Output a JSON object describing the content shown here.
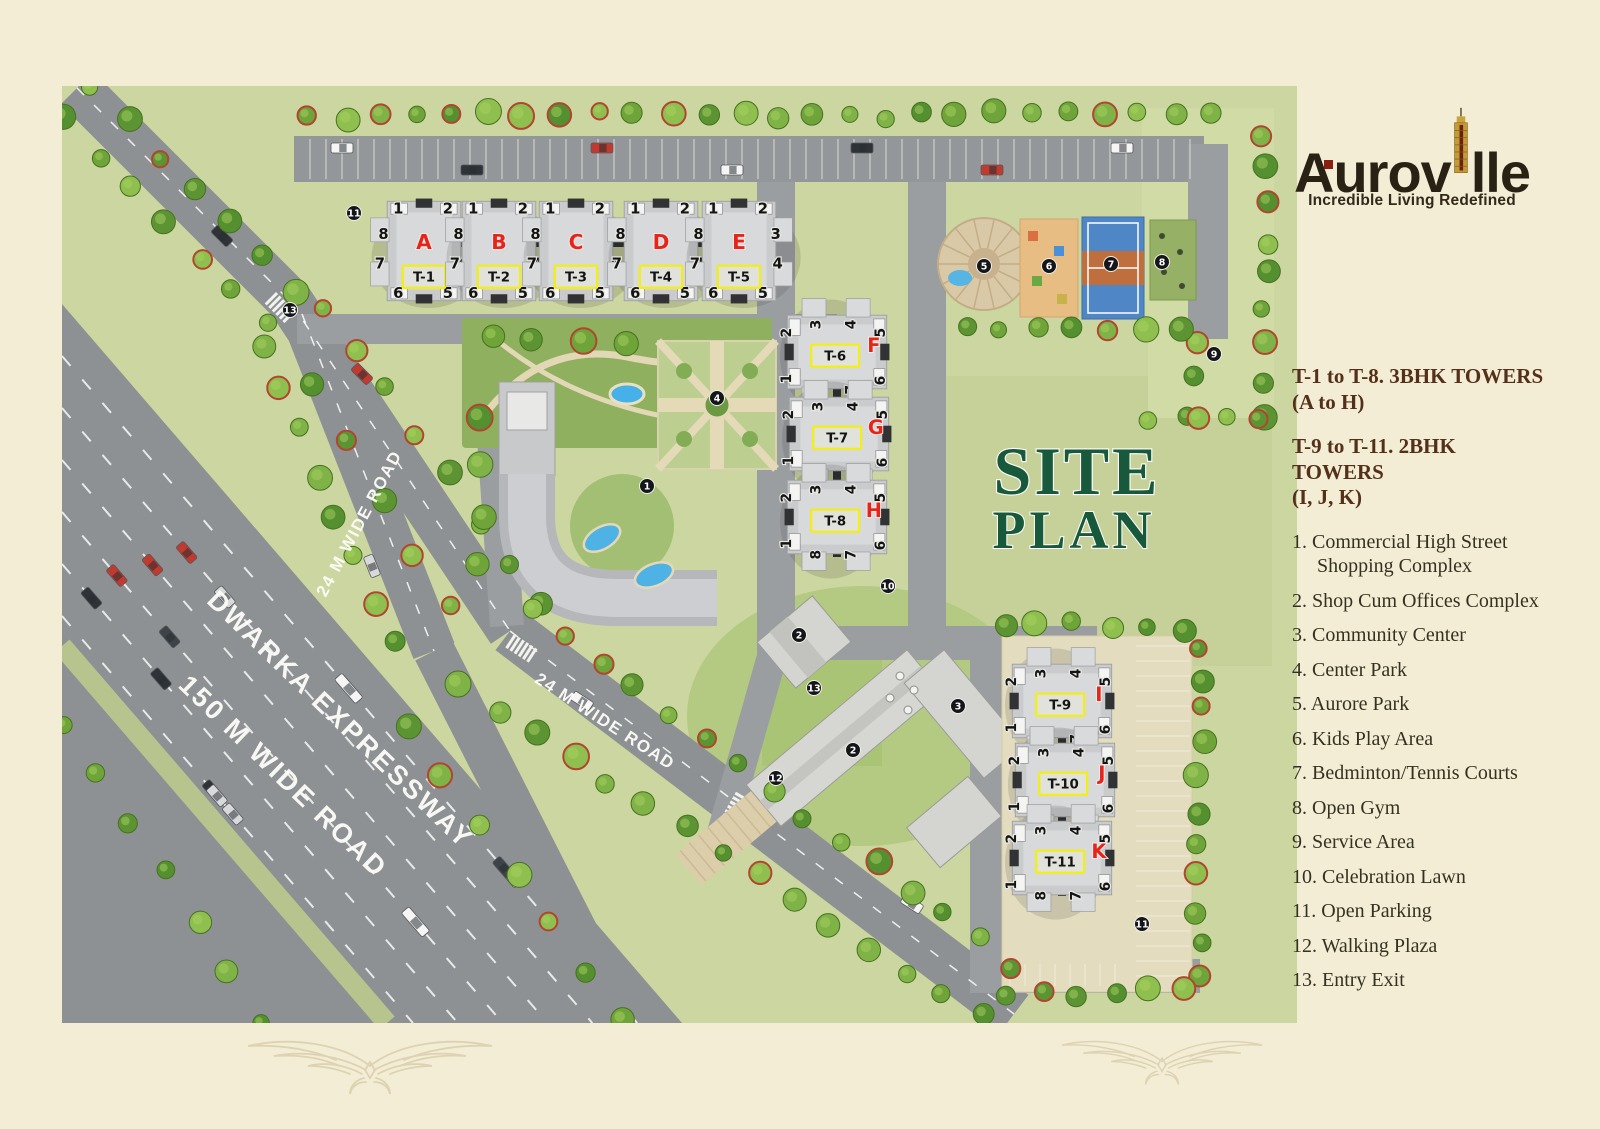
{
  "logo": {
    "name_prefix": "Aurov",
    "name_suffix": "lle",
    "tagline": "Incredible Living Redefined"
  },
  "title": {
    "line1": "SITE",
    "line2": "PLAN"
  },
  "tower_info": [
    {
      "line1": "T-1 to T-8. 3BHK TOWERS",
      "line2": "(A to H)"
    },
    {
      "line1": "T-9 to T-11. 2BHK TOWERS",
      "line2": "(I, J, K)"
    }
  ],
  "legend": {
    "items": [
      {
        "num": "1.",
        "label": "Commercial High Street Shopping Complex"
      },
      {
        "num": "2.",
        "label": "Shop Cum Offices Complex"
      },
      {
        "num": "3.",
        "label": "Community Center"
      },
      {
        "num": "4.",
        "label": "Center Park"
      },
      {
        "num": "5.",
        "label": "Aurore Park"
      },
      {
        "num": "6.",
        "label": "Kids Play Area"
      },
      {
        "num": "7.",
        "label": "Bedminton/Tennis Courts"
      },
      {
        "num": "8.",
        "label": "Open Gym"
      },
      {
        "num": "9.",
        "label": "Service Area"
      },
      {
        "num": "10.",
        "label": "Celebration Lawn"
      },
      {
        "num": "11.",
        "label": "Open Parking"
      },
      {
        "num": "12.",
        "label": "Walking Plaza"
      },
      {
        "num": "13.",
        "label": "Entry Exit"
      }
    ]
  },
  "map": {
    "road_labels": {
      "expressway_line1": "DWARKA EXPRESSWAY",
      "expressway_line2": "150 M WIDE ROAD",
      "road24_a": "24 M WIDE ROAD",
      "road24_b": "24 M WIDE ROAD"
    },
    "towers_row": [
      {
        "letter": "A",
        "code": "T-1"
      },
      {
        "letter": "B",
        "code": "T-2"
      },
      {
        "letter": "C",
        "code": "T-3"
      },
      {
        "letter": "D",
        "code": "T-4"
      },
      {
        "letter": "E",
        "code": "T-5"
      }
    ],
    "towers_mid": [
      {
        "letter": "F",
        "code": "T-6"
      },
      {
        "letter": "G",
        "code": "T-7"
      },
      {
        "letter": "H",
        "code": "T-8"
      }
    ],
    "towers_side": [
      {
        "letter": "I",
        "code": "T-9"
      },
      {
        "letter": "J",
        "code": "T-10"
      },
      {
        "letter": "K",
        "code": "T-11"
      }
    ],
    "unit_numbers_row": [
      "1",
      "2",
      "8",
      "3",
      "7",
      "4",
      "6",
      "5"
    ],
    "unit_numbers_side": [
      "2",
      "3",
      "4",
      "5",
      "1",
      "8",
      "7",
      "6"
    ],
    "markers": [
      {
        "n": "1",
        "x": 585,
        "y": 400
      },
      {
        "n": "2",
        "x": 737,
        "y": 549
      },
      {
        "n": "2",
        "x": 791,
        "y": 664
      },
      {
        "n": "3",
        "x": 896,
        "y": 620
      },
      {
        "n": "4",
        "x": 655,
        "y": 312
      },
      {
        "n": "5",
        "x": 922,
        "y": 180
      },
      {
        "n": "6",
        "x": 987,
        "y": 180
      },
      {
        "n": "7",
        "x": 1049,
        "y": 178
      },
      {
        "n": "8",
        "x": 1100,
        "y": 176
      },
      {
        "n": "9",
        "x": 1152,
        "y": 268
      },
      {
        "n": "10",
        "x": 826,
        "y": 500
      },
      {
        "n": "11",
        "x": 292,
        "y": 127
      },
      {
        "n": "11",
        "x": 1080,
        "y": 838
      },
      {
        "n": "12",
        "x": 714,
        "y": 692
      },
      {
        "n": "13",
        "x": 752,
        "y": 602
      },
      {
        "n": "13",
        "x": 228,
        "y": 224
      }
    ]
  },
  "colors": {
    "accent_red": "#e8231a",
    "box_yellow": "#f2ee17",
    "title_green": "#17593a",
    "heading_brown": "#54301b",
    "lawn": "#ccd6a0",
    "road": "#8e9193"
  }
}
